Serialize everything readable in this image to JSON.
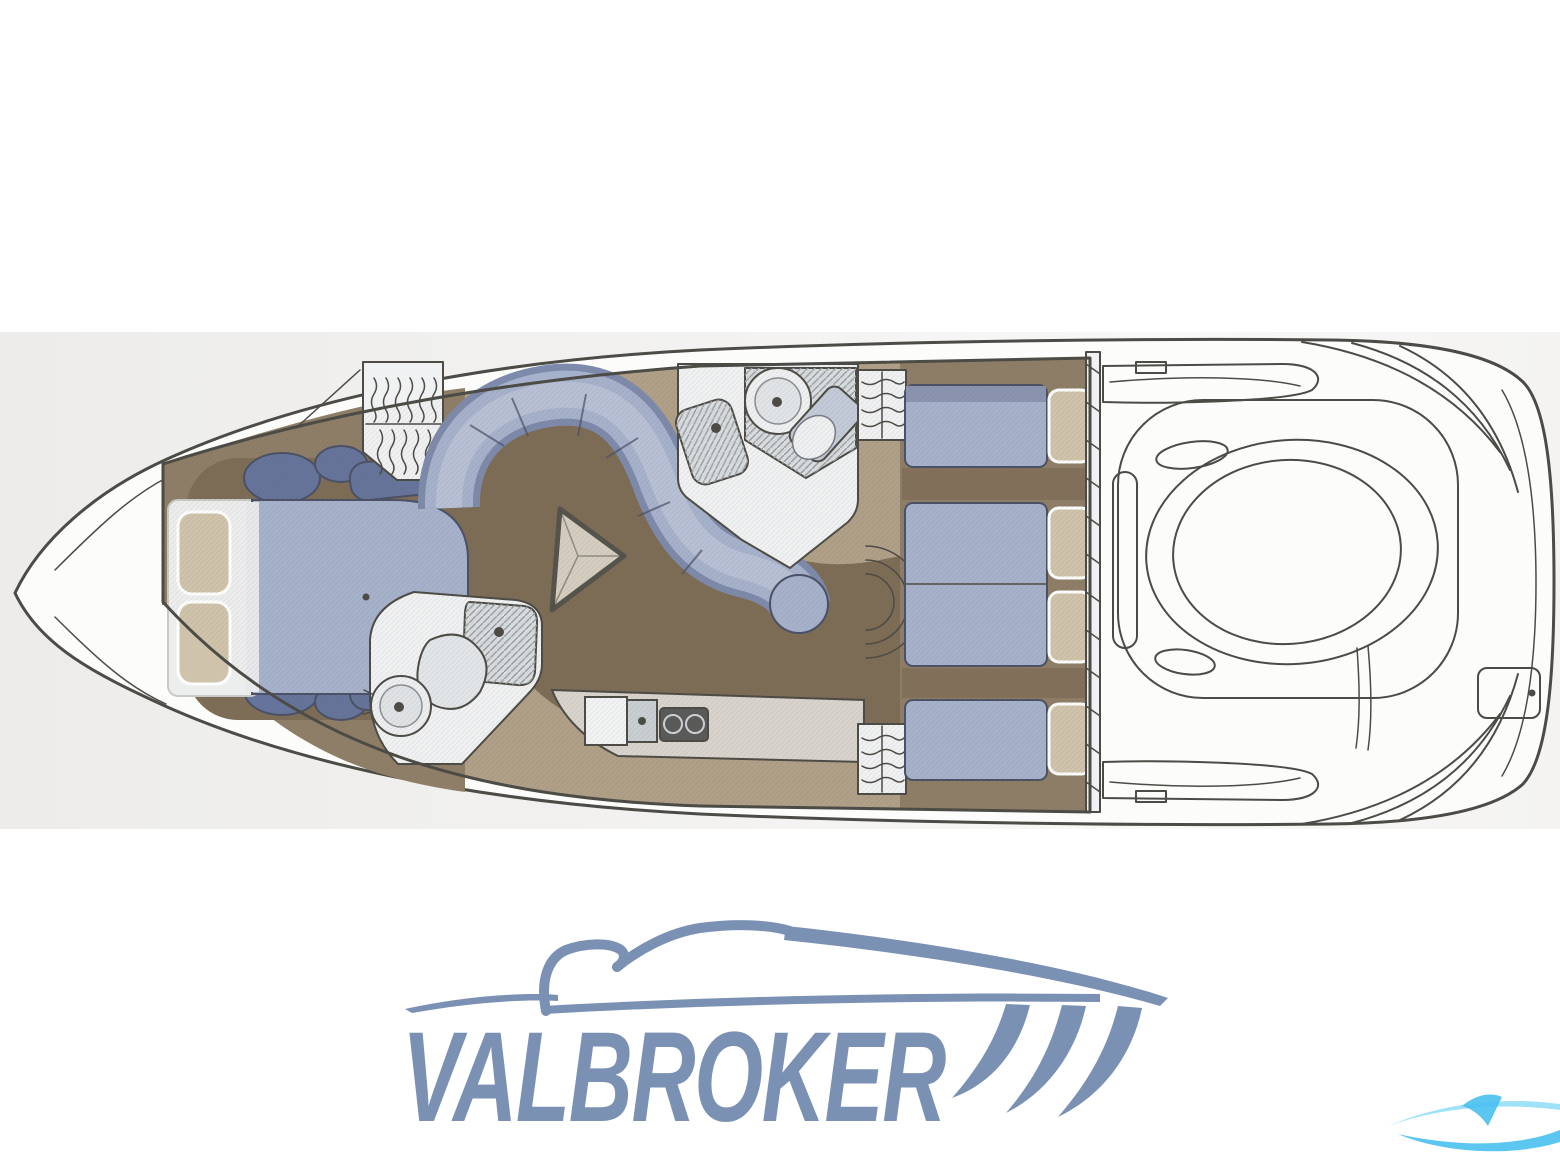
{
  "logo": {
    "text": "VALBROKER"
  },
  "floorplan": {
    "type": "yacht-interior-deck-plan",
    "features": [
      "bow",
      "v-berth-double-bed",
      "pillows",
      "bedside-stools",
      "hanging-locker",
      "forward-head",
      "shower-tray",
      "toilet",
      "wash-basin",
      "salon-s-shaped-sofa",
      "triangular-table",
      "galley-counter",
      "galley-sink",
      "two-burner-stove",
      "aft-head",
      "vanity-counter",
      "companionway-lockers",
      "aft-cabin-berths",
      "door-swing-arcs",
      "engine-room-bulkhead",
      "engine-hatch",
      "cockpit-side-decks",
      "transom",
      "swim-platform"
    ]
  },
  "palette": {
    "page_bg": "#ffffff",
    "scan_left": "#edecea",
    "scan_mid": "#f2f1ef",
    "scan_right": "#f7f7f5",
    "line": "#4c4b45",
    "hull_fill": "#fcfcfb",
    "floor_tan": "#b0a088",
    "floor_mid": "#8f7e67",
    "floor_dark": "#7d6c56",
    "fixture_white": "#f0f1f2",
    "fixture_gray": "#d9dde0",
    "counter": "#d8d4cd",
    "stove": "#5a5a58",
    "upholstery": "#a6b1cb",
    "upholstery_dark": "#66749b",
    "uph_edge": "#7e8aab",
    "uph_inner": "#b7c0d5",
    "uph_line": "#4b5166",
    "pillow": "#cfc3ab",
    "logo_blue": "#7b91b3",
    "wm_cyan": "#49c0ee",
    "wm_light": "#8edcf6"
  }
}
